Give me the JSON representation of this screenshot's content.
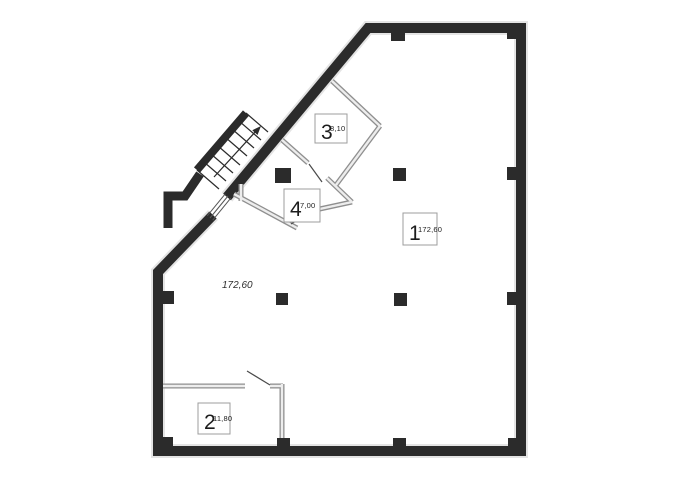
{
  "plan": {
    "type": "floor-plan",
    "hall": {
      "number": "1",
      "area_text": "172,60"
    },
    "rooms": [
      {
        "number": "1",
        "area": "172,60"
      },
      {
        "number": "2",
        "area": "11,80"
      },
      {
        "number": "3",
        "area": "8,10"
      },
      {
        "number": "4",
        "area": "7,00"
      }
    ],
    "colors": {
      "wall": "#2b2b2b",
      "wall_shadow": "#e2e2e2",
      "partition_edge": "#8f8f8f",
      "partition_core": "#ededed",
      "door_leaf": "#4a4a4a",
      "label_border": "#9c9c9c",
      "text": "#1c1c1c",
      "background": "#ffffff"
    }
  }
}
